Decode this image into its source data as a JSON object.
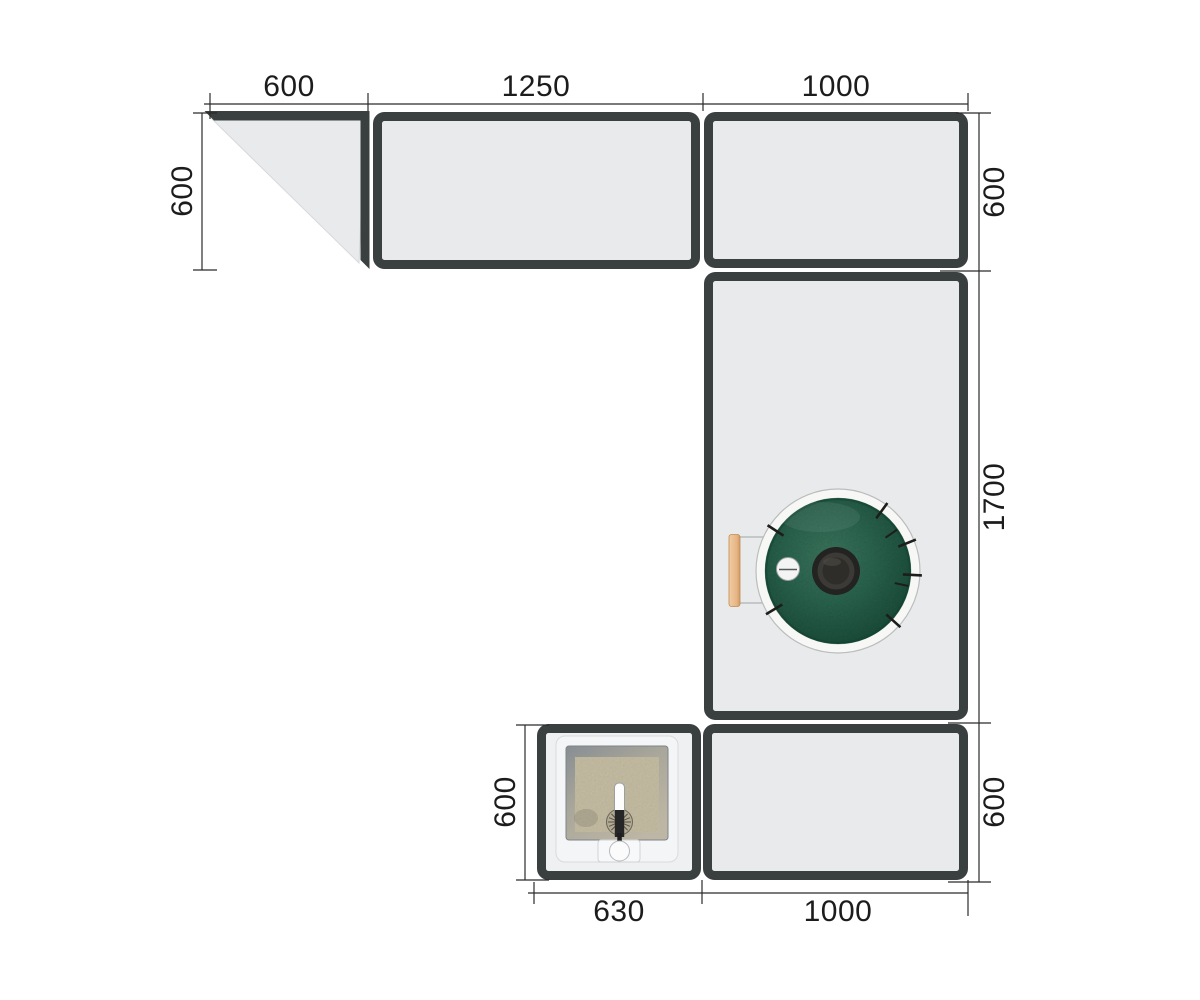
{
  "drawing": {
    "type": "outdoor-kitchen-plan-top-view",
    "units": "mm"
  },
  "dims": {
    "top_corner": "600",
    "top_counter": "1250",
    "top_right": "1000",
    "left_depth": "600",
    "right_top_depth": "600",
    "right_column_length": "1700",
    "right_bottom_depth": "600",
    "sink_depth": "600",
    "sink_width": "630",
    "bottom_right_width": "1000"
  },
  "fixtures": {
    "grill": "kamado-grill-top-view",
    "sink": "single-basin-sink-with-faucet"
  },
  "colors": {
    "panel_fill": "#e9eaec",
    "panel_border": "#3a4040",
    "dimension_ink": "#1c1c1c",
    "grill_green": "#2c6a53",
    "grill_band_white": "#f7f8f6",
    "handle_wood": "#e9bd8e",
    "basin_floor": "#cbc2a8"
  }
}
